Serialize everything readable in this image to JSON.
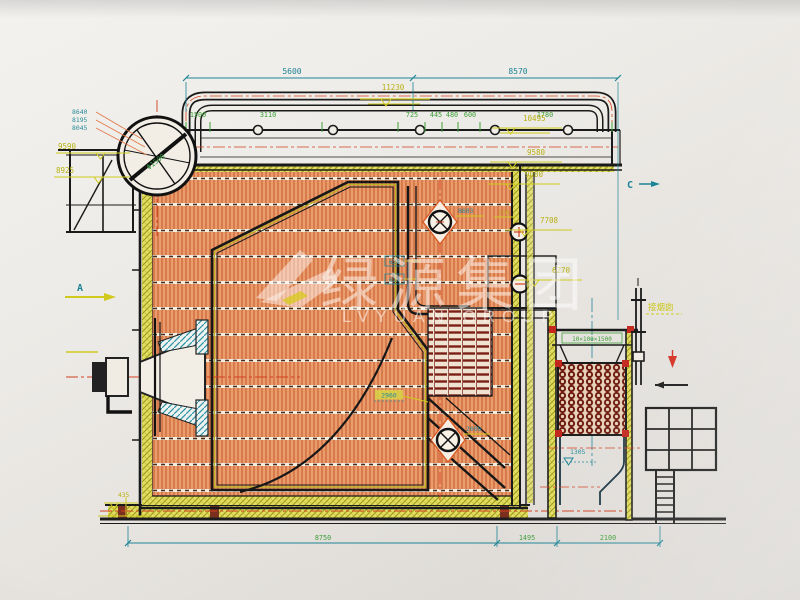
{
  "watermark": {
    "cn_name": "绿源集团",
    "en_name": "LVYUAN GROUP"
  },
  "view_labels": {
    "a": "A",
    "c": "C"
  },
  "dims_top": {
    "left_span": "5600",
    "right_span": "8570"
  },
  "header_dims": {
    "d1": "1500",
    "d2": "3110",
    "d3": "725",
    "d4": "445",
    "d5": "480",
    "d6": "600",
    "d7": "1780"
  },
  "bottom_dims": {
    "left": "8750",
    "mid": "1495",
    "right": "2100"
  },
  "elev_top": "11230",
  "elev_right": {
    "e10495": "10495",
    "e9580": "9580",
    "e9080": "9080",
    "e7708": "7708",
    "e6270": "6270"
  },
  "elev_left": {
    "e9590": "9590",
    "e8925": "8925",
    "e435": "435"
  },
  "drum_leaders": {
    "l1": "8640",
    "l2": "8195",
    "l3": "8045"
  },
  "annotations": {
    "manhole_top": "8603",
    "d770": "770",
    "grate_height": "2960",
    "manhole_bottom": "2008",
    "pipe_box1": "628",
    "pipe_box2": "619",
    "econ_elev": "1305"
  },
  "equipment": {
    "chimney_label": "接烟囱",
    "econ_spec": "10×100×1500",
    "drum_spec": "Φ1500"
  }
}
